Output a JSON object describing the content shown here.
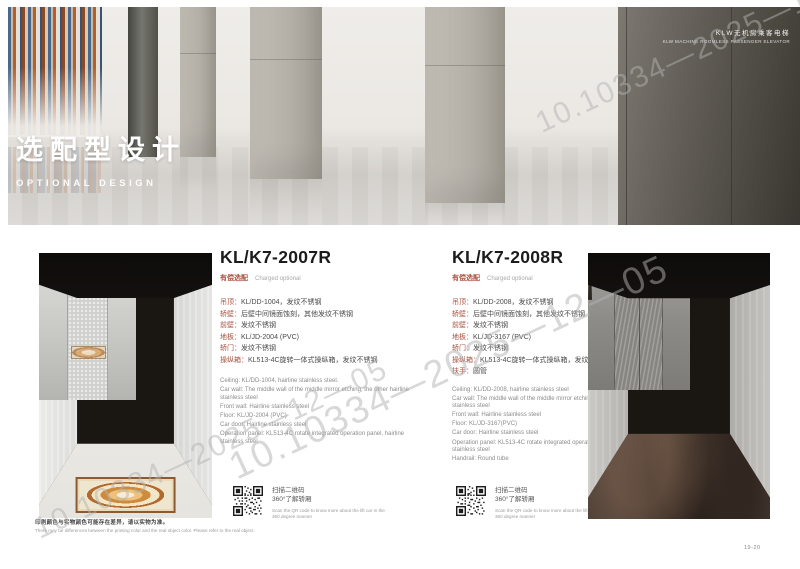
{
  "banner": {
    "corner_line1": "KLW无机房乘客电梯",
    "corner_line2": "KLW MACHINE ROOMLESS PASSENGER ELEVATOR",
    "title_cn": "选配型设计",
    "title_en": "OPTIONAL DESIGN"
  },
  "products": [
    {
      "model": "KL/K7-2007R",
      "paid_cn": "有偿选配",
      "paid_en": "Charged optional",
      "specs_cn": [
        {
          "label": "吊顶：",
          "value": "KL/DD-1004，发纹不锈钢"
        },
        {
          "label": "轿壁：",
          "value": "后壁中间镜面蚀刻，其他发纹不锈钢"
        },
        {
          "label": "前壁：",
          "value": "发纹不锈钢"
        },
        {
          "label": "地板：",
          "value": "KL/JD-2004 (PVC)"
        },
        {
          "label": "轿门：",
          "value": "发纹不锈钢"
        },
        {
          "label": "操纵箱：",
          "value": "KL513-4C旋转一体式操纵箱，发纹不锈钢"
        }
      ],
      "specs_en": [
        "Ceiling: KL/DD-1004, hairline stainless steel.",
        "Car wall: The middle wall of the middle mirror etching, the other hairline stainless steel",
        "Front wall: Hairline stainless steel",
        "Floor: KL/JD-2004 (PVC)",
        "Car door: Hairline stainless steel",
        "Operation panel: KL513-4C rotate integrated operation panel, hairline stainless steel"
      ],
      "qr": {
        "cn1": "扫描二维码",
        "cn2": "360°了解轿厢",
        "en": "Scan the QR code to know more about the lift car in the 360 degree manner"
      }
    },
    {
      "model": "KL/K7-2008R",
      "paid_cn": "有偿选配",
      "paid_en": "Charged optional",
      "specs_cn": [
        {
          "label": "吊顶：",
          "value": "KL/DD-2008，发纹不锈钢"
        },
        {
          "label": "轿壁：",
          "value": "后壁中间镜面蚀刻，其他发纹不锈钢"
        },
        {
          "label": "前壁：",
          "value": "发纹不锈钢"
        },
        {
          "label": "地板：",
          "value": "KL/JD-3167 (PVC)"
        },
        {
          "label": "轿门：",
          "value": "发纹不锈钢"
        },
        {
          "label": "操纵箱：",
          "value": "KL513-4C旋转一体式操纵箱，发纹不锈钢"
        },
        {
          "label": "扶手：",
          "value": "圆管"
        }
      ],
      "specs_en": [
        "Ceiling: KL/DD-2008, hairline stainless steel",
        "Car wall: The middle wall of the middle mirror etching, the other hairline stainless steel",
        "Front wall: Hairline stainless steel",
        "Floor: KL/JD-3167(PVC)",
        "Car door: Hairline stainless steel",
        "Operation panel: KL513-4C rotate integrated operation panel, hairline stainless steel",
        "Handrail: Round tube"
      ],
      "qr": {
        "cn1": "扫描二维码",
        "cn2": "360°了解轿厢",
        "en": "Scan the QR code to know more about the lift car in the 360 degree manner"
      }
    }
  ],
  "footer": {
    "note_cn": "印刷颜色与实物颜色可能存在差异，请以实物为准。",
    "note_en": "There may be differences between the printing color and the real object color. Please refer to the real object.",
    "page_no": "19-20"
  },
  "watermark": {
    "text": "10.10334—2025—12—05"
  },
  "colors": {
    "accent_red": "#a8503e",
    "panel_dark": "#4a473f"
  }
}
